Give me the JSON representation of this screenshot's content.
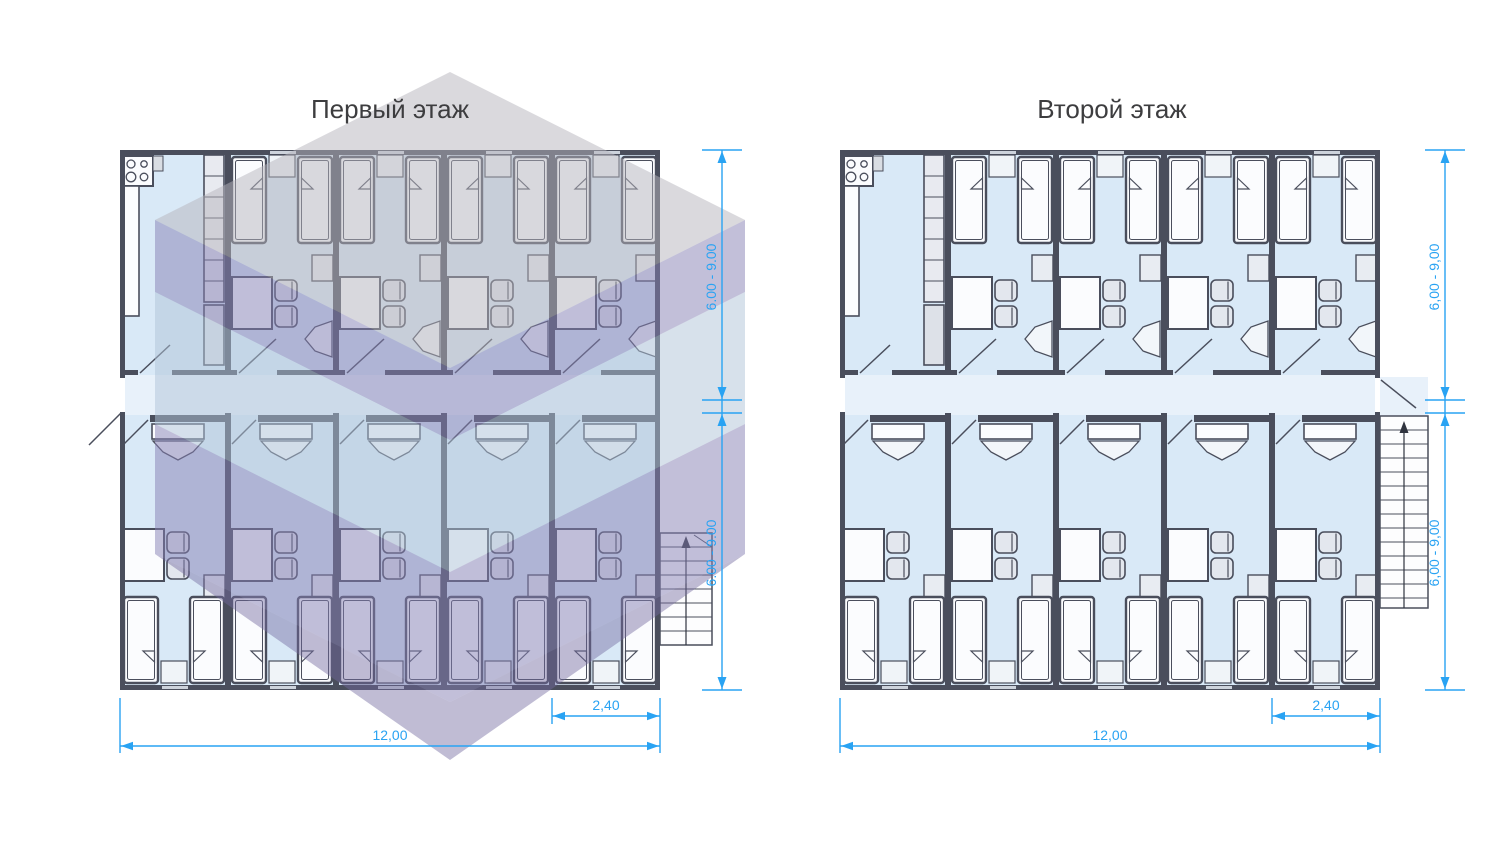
{
  "canvas": {
    "width": 1500,
    "height": 844,
    "background": "#ffffff"
  },
  "plans": [
    {
      "id": "first-floor",
      "title": "Первый этаж",
      "watermark": true,
      "dims": {
        "depth_top": "6.00 - 9.00",
        "depth_bottom": "6.00 - 9.00",
        "module_width": "2,40",
        "total_width": "12,00"
      }
    },
    {
      "id": "second-floor",
      "title": "Второй этаж",
      "watermark": false,
      "dims": {
        "depth_top": "6,00 - 9,00",
        "depth_bottom": "6,00 - 9,00",
        "module_width": "2,40",
        "total_width": "12,00"
      }
    }
  ],
  "structure": {
    "bands_per_floor": 2,
    "modules_per_band": 5,
    "module_width_m": 2.4,
    "total_width_m": 12.0,
    "band_depth_range_m": "6.00 - 9.00",
    "beds_per_room": 2,
    "kitchen_position": "top-left module",
    "staircase_position": "outside right wall",
    "corridor": "central horizontal"
  },
  "colors": {
    "dimension_blue": "#29a3f3",
    "wall_dark": "#4a4e5c",
    "room_floor": "#d9e9f7",
    "corridor_floor": "#e8f1fa",
    "furniture_fill": "#fbfcfe",
    "chair_fill": "#e3e7ee",
    "watermark_gray": "#b5b3bc",
    "watermark_purple": "#8580b4",
    "watermark_blue": "#afc3d8",
    "title_text": "#3d3d3f"
  }
}
